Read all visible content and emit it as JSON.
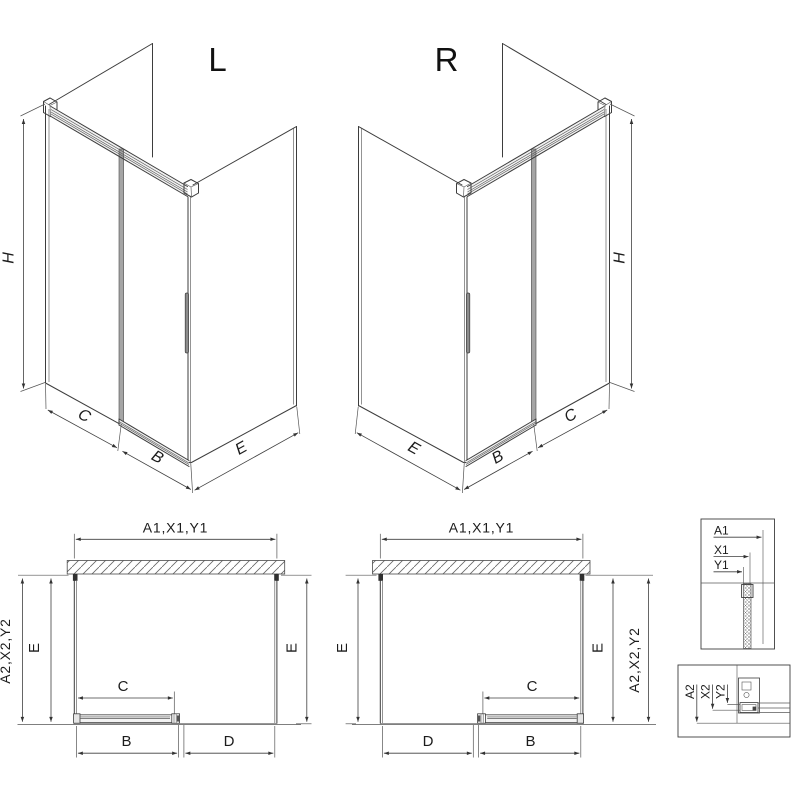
{
  "page": {
    "background": "#ffffff"
  },
  "colors": {
    "line": "#3d3d3d",
    "dim_line": "#3f3f3f",
    "door_glass_gray": "#a5a5a5",
    "handle_gray": "#8c8c8c",
    "rail_fill": "#f1f1f1",
    "hatch": "#666666"
  },
  "views": {
    "l3d": {
      "label": "L",
      "dim_height": "H",
      "dim_c": "C",
      "dim_b": "B",
      "dim_e": "E"
    },
    "r3d": {
      "label": "R",
      "dim_height": "H",
      "dim_c": "C",
      "dim_b": "B",
      "dim_e": "E"
    },
    "plan_left": {
      "dim_width": "A1,X1,Y1",
      "dim_depth": "A2,X2,Y2",
      "dim_e_left": "E",
      "dim_e_right": "E",
      "dim_c": "C",
      "dim_b": "B",
      "dim_d": "D"
    },
    "plan_right": {
      "dim_width": "A1,X1,Y1",
      "dim_depth": "A2,X2,Y2",
      "dim_e_left": "E",
      "dim_e_right": "E",
      "dim_c": "C",
      "dim_b": "B",
      "dim_d": "D"
    },
    "detail_top_profile": {
      "dim_a1": "A1",
      "dim_x1": "X1",
      "dim_y1": "Y1"
    },
    "detail_bottom_profile": {
      "dim_a2": "A2",
      "dim_x2": "X2",
      "dim_y2": "Y2"
    }
  }
}
